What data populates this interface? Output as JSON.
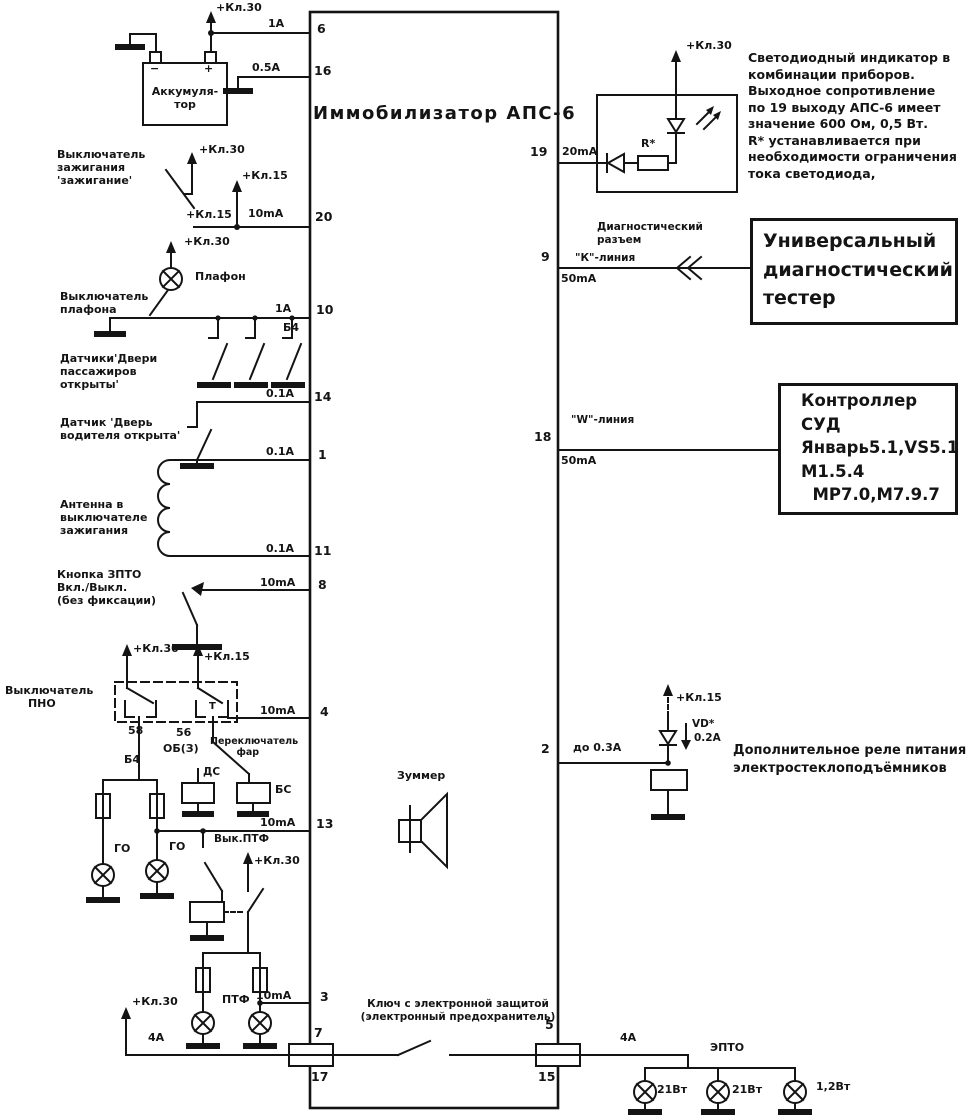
{
  "diagram": {
    "title": "Иммобилизатор АПС-6",
    "power": {
      "kl30": "+Кл.30",
      "kl15": "+Кл.15"
    },
    "battery": {
      "name": "Аккумуля-\nтор",
      "minus": "−",
      "plus": "+"
    },
    "pins": {
      "p6": {
        "num": "6",
        "current": "1А"
      },
      "p16": {
        "num": "16",
        "current": "0.5А"
      },
      "p20": {
        "num": "20",
        "current": "10mA"
      },
      "p10": {
        "num": "10",
        "current": "1А",
        "wire": "Б4"
      },
      "p14": {
        "num": "14",
        "current": "0.1А"
      },
      "p1": {
        "num": "1",
        "current": "0.1А"
      },
      "p11": {
        "num": "11",
        "current": "0.1А"
      },
      "p8": {
        "num": "8",
        "current": "10mA"
      },
      "p4": {
        "num": "4",
        "current": "10mA"
      },
      "p13": {
        "num": "13",
        "current": "10mA"
      },
      "p3": {
        "num": "3",
        "current": "10mA"
      },
      "p7": {
        "num": "7"
      },
      "p17": {
        "num": "17"
      },
      "p19": {
        "num": "19",
        "current": "20mA"
      },
      "p9": {
        "num": "9",
        "current": "50mA"
      },
      "p18": {
        "num": "18",
        "current": "50mA"
      },
      "p2": {
        "num": "2",
        "current": "до 0.3А"
      },
      "p5": {
        "num": "5"
      },
      "p15": {
        "num": "15"
      }
    },
    "left": {
      "ignition_switch": "Выключатель\nзажигания\n'зажигание'",
      "plafon": "Плафон",
      "plafon_switch": "Выключатель\nплафона",
      "passenger_doors": "Датчики'Двери\nпассажиров\nоткрыты'",
      "driver_door": "Датчик 'Дверь\nводителя открыта'",
      "antenna": "Антенна в\nвыключателе\nзажигания",
      "zpto_button": "Кнопка ЗПТО\nВкл./Выкл.\n(без фиксации)",
      "pno_switch": "Выключатель\n      ПНО",
      "t": "Т",
      "term_58": "58",
      "term_56": "56",
      "term_ob3": "ОБ(З)",
      "wire_b4": "Б4",
      "headlight_switch": "Переключатель\n        фар",
      "ds": "ДС",
      "bs": "БС",
      "go": "ГО",
      "ptf_switch": "Вык.ПТФ",
      "ptf": "ПТФ",
      "fuse_4a": "4А"
    },
    "center": {
      "buzzer": "Зуммер",
      "key_note": "Ключ с электронной защитой\n(электронный предохранитель)"
    },
    "right": {
      "r_star": "R*",
      "led_note": "Светодиодный индикатор в\nкомбинации приборов.\nВыходное сопротивление\nпо 19 выходу АПС-6 имеет\nзначение 600 Ом, 0,5 Вт.\nR* устанавливается при\nнеобходимости ограничения\nтока светодиода,",
      "diag_connector": "Диагностический\nразъем",
      "k_line": "\"К\"-линия",
      "w_line": "\"W\"-линия",
      "tester": "Универсальный\nдиагностический\nтестер",
      "controller": "Контроллер\nСУД\nЯнварь5.1,VS5.1\nМ1.5.4\n  МР7.0,М7.9.7",
      "vd": "VD*",
      "vd_current": "0.2А",
      "relay_note": "Дополнительное реле питания\nэлектростеклоподъёмников",
      "fuse_4a": "4А",
      "epto": "ЭПТО",
      "lamp_21w": "21Вт",
      "lamp_12w": "1,2Вт"
    }
  }
}
